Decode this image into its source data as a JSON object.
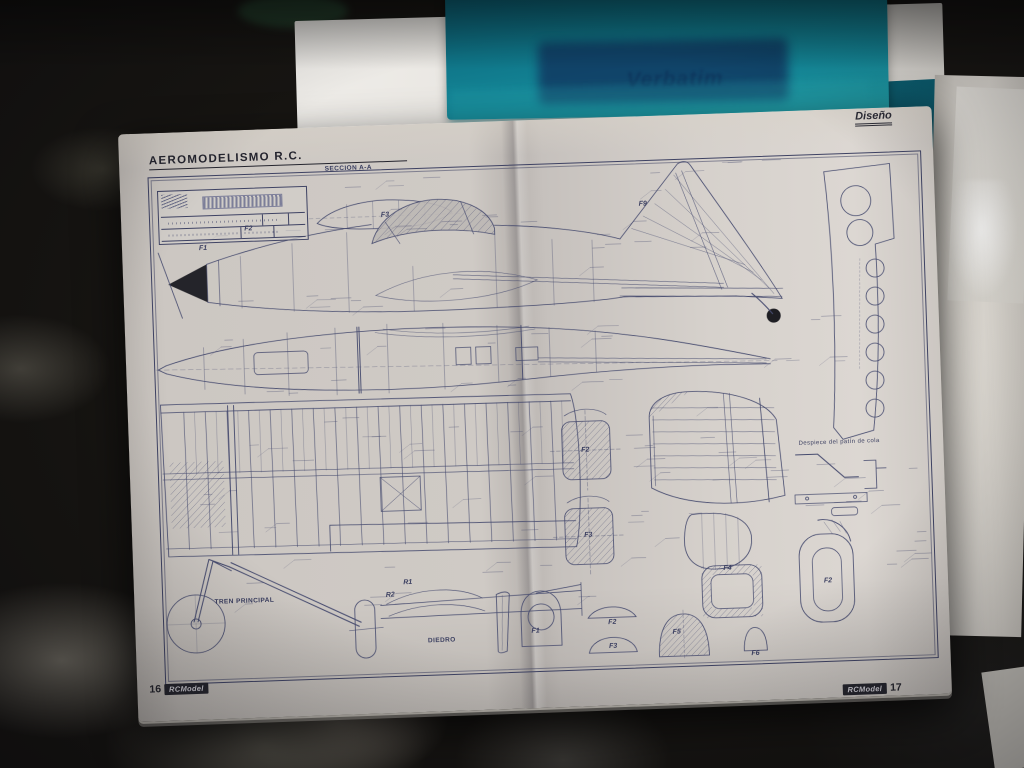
{
  "scene": {
    "folder_brand": "Verbatim"
  },
  "magazine": {
    "header": {
      "section": "Diseño",
      "title": "AEROMODELISMO R.C."
    },
    "footer": {
      "left": {
        "page_number": "16",
        "logo": "RCModel"
      },
      "right": {
        "page_number": "17",
        "logo": "RCModel"
      }
    },
    "plan": {
      "callouts": {
        "seccion_aa": "SECCION A-A",
        "tren_principal": "TREN PRINCIPAL",
        "diedro": "DIEDRO",
        "despiece_patin": "Despiece del patín de cola"
      },
      "part_labels": [
        {
          "text": "F1"
        },
        {
          "text": "F2"
        },
        {
          "text": "F3"
        },
        {
          "text": "F9"
        },
        {
          "text": "F2"
        },
        {
          "text": "F3"
        },
        {
          "text": "F1"
        },
        {
          "text": "F2"
        },
        {
          "text": "F3"
        },
        {
          "text": "F4"
        },
        {
          "text": "F5"
        },
        {
          "text": "F6"
        },
        {
          "text": "R1"
        },
        {
          "text": "R2"
        },
        {
          "text": "F2"
        }
      ]
    }
  },
  "colors": {
    "plan_line": "#454a6e",
    "paper": "#cfcac5",
    "folder_teal": "#14899a",
    "ink_dark": "#24242e"
  }
}
